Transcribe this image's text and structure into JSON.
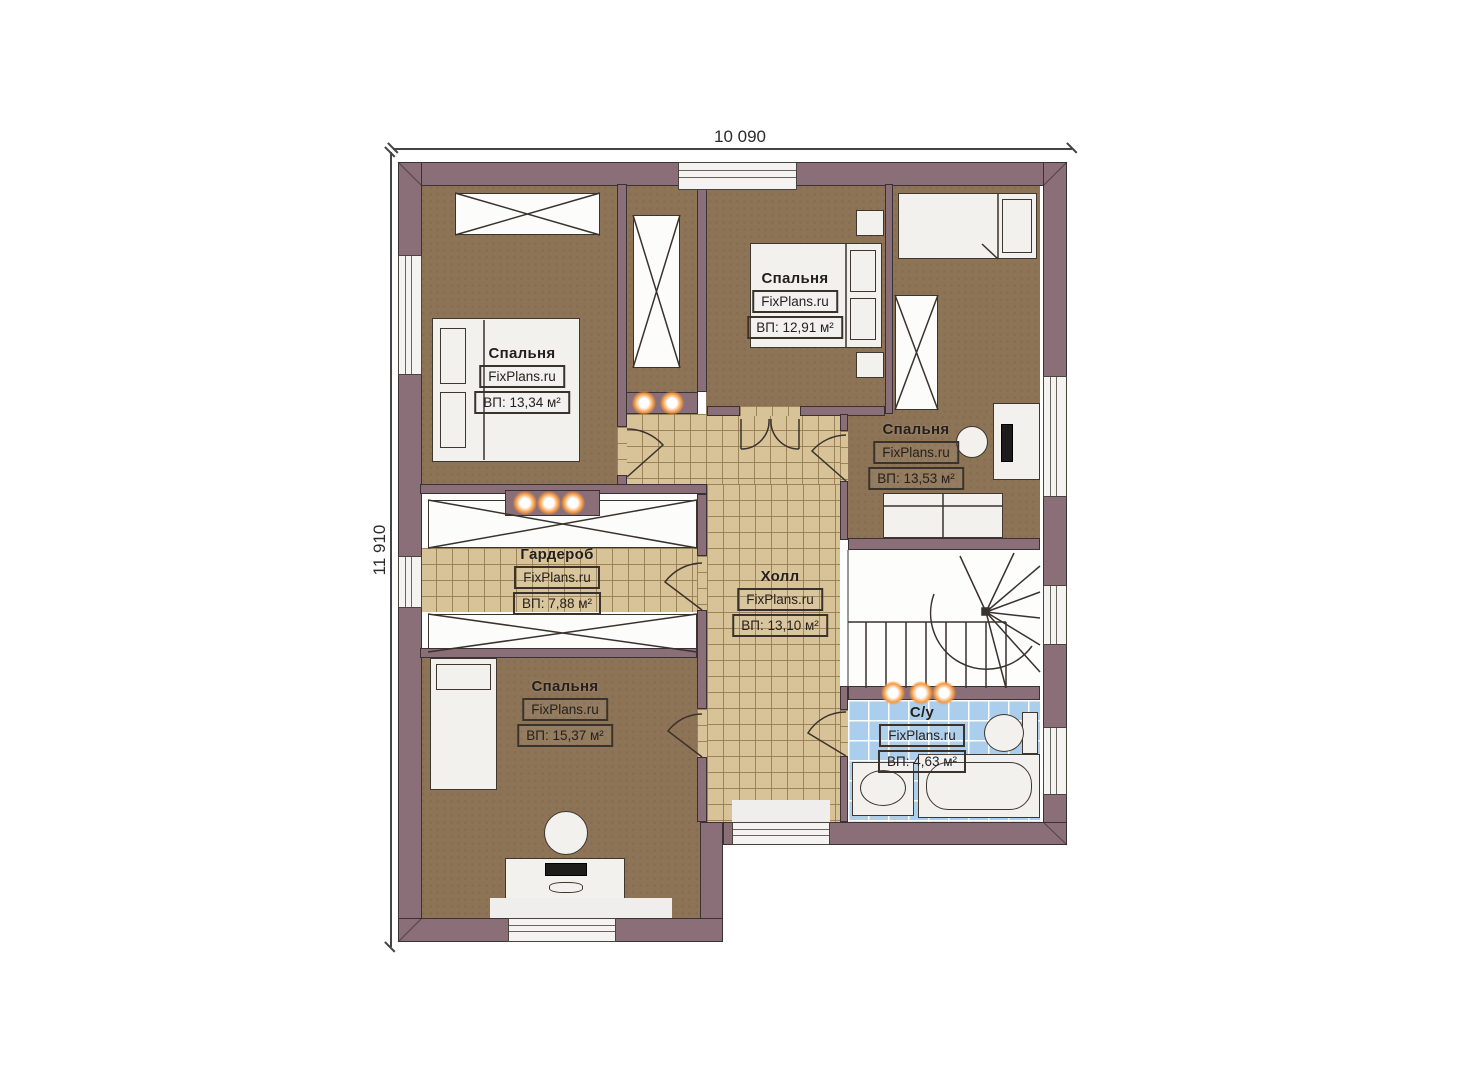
{
  "plan": {
    "dimensions": {
      "width_label": "10 090",
      "height_label": "11 910"
    },
    "rooms": [
      {
        "name": "Спальня",
        "watermark": "FixPlans.ru",
        "area": "ВП: 13,34 м²"
      },
      {
        "name": "Спальня",
        "watermark": "FixPlans.ru",
        "area": "ВП: 12,91 м²"
      },
      {
        "name": "Спальня",
        "watermark": "FixPlans.ru",
        "area": "ВП: 13,53 м²"
      },
      {
        "name": "Гардероб",
        "watermark": "FixPlans.ru",
        "area": "ВП: 7,88 м²"
      },
      {
        "name": "Холл",
        "watermark": "FixPlans.ru",
        "area": "ВП: 13,10 м²"
      },
      {
        "name": "Спальня",
        "watermark": "FixPlans.ru",
        "area": "ВП: 15,37 м²"
      },
      {
        "name": "С/у",
        "watermark": "FixPlans.ru",
        "area": "ВП: 4,63 м²"
      }
    ],
    "colors": {
      "wall": "#8a6f78",
      "bedroom_floor": "#8e7457",
      "tile_floor": "#d8c398",
      "bathroom_tile": "#abceec",
      "light_glow": "#f6993f"
    }
  }
}
